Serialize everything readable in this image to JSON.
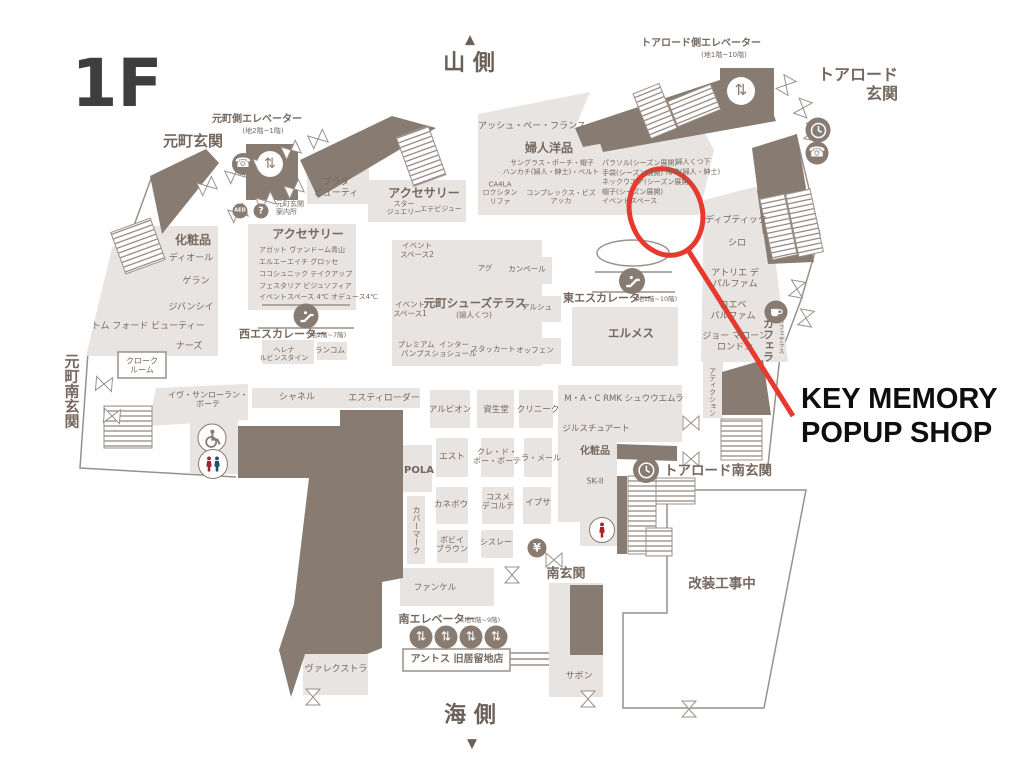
{
  "colors": {
    "floor": "#e8e4e1",
    "dark": "#877b72",
    "ink": "#75685f",
    "line": "#9a9089",
    "red": "#e8392f"
  },
  "annotation": {
    "label": "KEY MEMORY\nPOPUP SHOP"
  },
  "map": {
    "labels": [
      {
        "n": "floor-title",
        "t": "1F",
        "x": 117,
        "y": 84,
        "s": 66,
        "w": "b",
        "c": "#3e3e40"
      },
      {
        "n": "compass-north-arrow",
        "t": "▲",
        "x": 470,
        "y": 40,
        "s": 13,
        "w": "b",
        "c": "#6b6058"
      },
      {
        "n": "compass-north",
        "t": "山 側",
        "x": 469,
        "y": 64,
        "s": 22,
        "w": "b",
        "c": "#6b6058"
      },
      {
        "n": "compass-south",
        "t": "海 側",
        "x": 470,
        "y": 716,
        "s": 22,
        "w": "b",
        "c": "#6b6058"
      },
      {
        "n": "compass-south-arrow",
        "t": "▼",
        "x": 472,
        "y": 744,
        "s": 13,
        "w": "b",
        "c": "#6b6058"
      },
      {
        "n": "motomachi-entrance",
        "t": "元町玄関",
        "x": 193,
        "y": 142,
        "s": 15,
        "w": "b"
      },
      {
        "n": "motomachi-elevator",
        "t": "元町側エレベーター",
        "x": 257,
        "y": 120,
        "s": 10,
        "w": "b"
      },
      {
        "n": "motomachi-elevator-floors",
        "t": "(地2階~1階)",
        "x": 263,
        "y": 131,
        "s": 7
      },
      {
        "n": "motomachi-info",
        "t": "元町玄関\n案内所",
        "x": 276,
        "y": 208,
        "s": 7,
        "a": "l"
      },
      {
        "n": "motomachi-south-entrance",
        "t": "元町南玄関",
        "x": 71,
        "y": 391,
        "s": 15,
        "w": "b",
        "v": true
      },
      {
        "n": "tor-road-entrance",
        "t": "トアロード\n玄関",
        "x": 858,
        "y": 85,
        "s": 16,
        "w": "b",
        "a": "r"
      },
      {
        "n": "tor-road-elevator",
        "t": "トアロード側エレベーター",
        "x": 701,
        "y": 44,
        "s": 10,
        "w": "b"
      },
      {
        "n": "tor-road-elevator-floors",
        "t": "(地1階~10階)",
        "x": 724,
        "y": 55,
        "s": 7
      },
      {
        "n": "tor-road-south-entrance",
        "t": "トアロード南玄関",
        "x": 718,
        "y": 472,
        "s": 13.5,
        "w": "b"
      },
      {
        "n": "south-entrance",
        "t": "南玄関",
        "x": 566,
        "y": 574,
        "s": 13,
        "w": "b"
      },
      {
        "n": "renovation-area-label",
        "t": "改装工事中",
        "x": 722,
        "y": 585,
        "s": 13.5,
        "w": "b"
      },
      {
        "n": "south-elevator",
        "t": "南エレベーター",
        "x": 437,
        "y": 620,
        "s": 11,
        "w": "b"
      },
      {
        "n": "south-elevator-floors",
        "t": "(地1階~9階)",
        "x": 481,
        "y": 621,
        "s": 6.5
      },
      {
        "n": "west-escalator",
        "t": "西エスカレーター",
        "x": 283,
        "y": 335,
        "s": 11,
        "w": "b"
      },
      {
        "n": "west-escalator-floors",
        "t": "(地2階~7階)",
        "x": 327,
        "y": 336,
        "s": 6.5
      },
      {
        "n": "east-escalator",
        "t": "東エスカレーター",
        "x": 607,
        "y": 299,
        "s": 11,
        "w": "b"
      },
      {
        "n": "east-escalator-floors",
        "t": "(地1階~10階)",
        "x": 656,
        "y": 300,
        "s": 6.5
      },
      {
        "n": "store-prada-beauty",
        "t": "プラダ\nビューティ",
        "x": 336,
        "y": 188,
        "s": 9
      },
      {
        "n": "accessories-upper",
        "t": "アクセサリー",
        "x": 424,
        "y": 193,
        "s": 12,
        "w": "b"
      },
      {
        "n": "store-star-jewelry",
        "t": "スター\nジュエリー",
        "x": 404,
        "y": 208,
        "s": 7
      },
      {
        "n": "store-etebijou",
        "t": "エテビジュー",
        "x": 441,
        "y": 209,
        "s": 7
      },
      {
        "n": "store-hp-france",
        "t": "アッシュ・ペー・フランス",
        "x": 532,
        "y": 127,
        "s": 9
      },
      {
        "n": "womens-goods",
        "t": "婦人洋品",
        "x": 549,
        "y": 148,
        "s": 12,
        "w": "b"
      },
      {
        "n": "goods-sunglasses",
        "t": "サングラス・ポーチ・帽子",
        "x": 552,
        "y": 163,
        "s": 7
      },
      {
        "n": "goods-handkerchief",
        "t": "ハンカチ(婦人・紳士)・ベルト",
        "x": 551,
        "y": 172,
        "s": 7
      },
      {
        "n": "store-ca4la-loccitane-refa",
        "t": "CA4LA\nロクシタン\nリファ",
        "x": 500,
        "y": 193,
        "s": 7
      },
      {
        "n": "store-complex-biz-acca",
        "t": "コンプレックス・ビズ\nアッカ",
        "x": 561,
        "y": 197,
        "s": 7
      },
      {
        "n": "goods-parasol",
        "t": "パラソル(シーズン展開)",
        "x": 602,
        "y": 163,
        "s": 7,
        "a": "l"
      },
      {
        "n": "goods-gloves",
        "t": "手袋(シーズン展開)",
        "x": 602,
        "y": 173,
        "s": 7,
        "a": "l"
      },
      {
        "n": "goods-neckwear",
        "t": "ネックウエア(シーズン展開)",
        "x": 602,
        "y": 182,
        "s": 7,
        "a": "l"
      },
      {
        "n": "goods-hats",
        "t": "帽子(シーズン展開)",
        "x": 602,
        "y": 192,
        "s": 7,
        "a": "l"
      },
      {
        "n": "event-space",
        "t": "イベントスペース",
        "x": 602,
        "y": 201,
        "s": 7,
        "a": "l"
      },
      {
        "n": "goods-womens-socks",
        "t": "婦人くつ下",
        "x": 693,
        "y": 162,
        "s": 7
      },
      {
        "n": "goods-umbrellas",
        "t": "雨傘(婦人・紳士)",
        "x": 693,
        "y": 172,
        "s": 7
      },
      {
        "n": "store-diptyque",
        "t": "ディプティック",
        "x": 736,
        "y": 221,
        "s": 9
      },
      {
        "n": "store-shiro",
        "t": "シロ",
        "x": 737,
        "y": 244,
        "s": 9
      },
      {
        "n": "store-atelier-des-parfums",
        "t": "アトリエ デ\nパルファム",
        "x": 735,
        "y": 279,
        "s": 9
      },
      {
        "n": "store-loewe-perfumes",
        "t": "ロエベ\nパルファム",
        "x": 733,
        "y": 311,
        "s": 9
      },
      {
        "n": "store-jo-malone-london",
        "t": "ジョー マローン\nロンドン",
        "x": 735,
        "y": 342,
        "s": 9
      },
      {
        "n": "store-caffera",
        "t": "カフェラ",
        "x": 768,
        "y": 340,
        "s": 11,
        "w": "b",
        "v": true
      },
      {
        "n": "cafe-terrace",
        "t": "カフェテラス",
        "x": 780,
        "y": 336,
        "s": 6,
        "v": true
      },
      {
        "n": "store-addiction",
        "t": "アディクション",
        "x": 712,
        "y": 392,
        "s": 7,
        "v": true
      },
      {
        "n": "cosmetics-left",
        "t": "化粧品",
        "x": 193,
        "y": 240,
        "s": 12,
        "w": "b"
      },
      {
        "n": "store-dior",
        "t": "ディオール",
        "x": 191,
        "y": 259,
        "s": 9
      },
      {
        "n": "store-guerlain",
        "t": "ゲラン",
        "x": 196,
        "y": 282,
        "s": 9
      },
      {
        "n": "store-givenchy",
        "t": "ジバンシイ",
        "x": 191,
        "y": 308,
        "s": 9
      },
      {
        "n": "store-tom-ford-beauty",
        "t": "トム フォード ビューティー",
        "x": 148,
        "y": 327,
        "s": 9
      },
      {
        "n": "store-nars",
        "t": "ナーズ",
        "x": 189,
        "y": 347,
        "s": 9
      },
      {
        "n": "cloakroom",
        "t": "クローク\nルーム",
        "x": 142,
        "y": 366,
        "s": 8
      },
      {
        "n": "accessories-left",
        "t": "アクセサリー",
        "x": 308,
        "y": 234,
        "s": 12,
        "w": "b"
      },
      {
        "n": "store-agete-vendome",
        "t": "アガット ヴァンドーム青山",
        "x": 259,
        "y": 250,
        "s": 7,
        "a": "l"
      },
      {
        "n": "store-lah-grosse",
        "t": "エルエーエイチ グロッセ",
        "x": 259,
        "y": 262,
        "s": 7,
        "a": "l"
      },
      {
        "n": "store-cocoshnik-takeup",
        "t": "ココシュニック テイクアップ",
        "x": 259,
        "y": 274,
        "s": 7,
        "a": "l"
      },
      {
        "n": "store-festaria",
        "t": "フェスタリア ビジュソフィア",
        "x": 259,
        "y": 286,
        "s": 7,
        "a": "l"
      },
      {
        "n": "store-event-4c",
        "t": "イベントスペース 4℃ オデュース4℃",
        "x": 259,
        "y": 297,
        "s": 7,
        "a": "l"
      },
      {
        "n": "store-helena-rubinstein",
        "t": "ヘレナ\nルビンスタイン",
        "x": 284,
        "y": 354,
        "s": 7
      },
      {
        "n": "store-lancome",
        "t": "ランコム",
        "x": 330,
        "y": 351,
        "s": 7.5
      },
      {
        "n": "event-space-2",
        "t": "イベント\nスペース2",
        "x": 417,
        "y": 251,
        "s": 7.5
      },
      {
        "n": "store-ugg",
        "t": "アグ",
        "x": 485,
        "y": 269,
        "s": 7.5
      },
      {
        "n": "store-camper",
        "t": "カンペール",
        "x": 527,
        "y": 270,
        "s": 7.5
      },
      {
        "n": "shoes-terrace",
        "t": "元町シューズテラス",
        "x": 475,
        "y": 304,
        "s": 11.5,
        "w": "b"
      },
      {
        "n": "shoes-terrace-sub",
        "t": "(婦人くつ)",
        "x": 474,
        "y": 316,
        "s": 7.5
      },
      {
        "n": "event-space-1",
        "t": "イベント\nスペース1",
        "x": 410,
        "y": 310,
        "s": 7.5
      },
      {
        "n": "store-arche",
        "t": "アルシュ",
        "x": 537,
        "y": 308,
        "s": 7.5
      },
      {
        "n": "store-premium-pumps",
        "t": "プレミアム\nパンプス",
        "x": 416,
        "y": 350,
        "s": 7.5
      },
      {
        "n": "store-inter-chaussures",
        "t": "インター\nショシュール",
        "x": 454,
        "y": 350,
        "s": 7.5
      },
      {
        "n": "store-staccato",
        "t": "スタッカート",
        "x": 493,
        "y": 350,
        "s": 7.5
      },
      {
        "n": "store-offen",
        "t": "オッフェン",
        "x": 535,
        "y": 351,
        "s": 7.5
      },
      {
        "n": "store-hermes",
        "t": "エルメス",
        "x": 631,
        "y": 334,
        "s": 11.5,
        "w": "b"
      },
      {
        "n": "store-ysl-beaute",
        "t": "イヴ・サンローラン・\nボーテ",
        "x": 208,
        "y": 400,
        "s": 8
      },
      {
        "n": "store-chanel",
        "t": "シャネル",
        "x": 297,
        "y": 398,
        "s": 9
      },
      {
        "n": "store-estee-lauder",
        "t": "エスティローダー",
        "x": 384,
        "y": 399,
        "s": 9
      },
      {
        "n": "store-albion",
        "t": "アルビオン",
        "x": 450,
        "y": 410,
        "s": 8.5
      },
      {
        "n": "store-shiseido",
        "t": "資生堂",
        "x": 496,
        "y": 410,
        "s": 8.5
      },
      {
        "n": "store-clinique",
        "t": "クリニーク",
        "x": 538,
        "y": 410,
        "s": 8.5
      },
      {
        "n": "store-est",
        "t": "エスト",
        "x": 452,
        "y": 457,
        "s": 8.5
      },
      {
        "n": "store-cle-de-peau",
        "t": "クレ・ド・\nポー・ボーテ",
        "x": 497,
        "y": 457,
        "s": 8
      },
      {
        "n": "store-la-mer",
        "t": "ラ・メール",
        "x": 541,
        "y": 458,
        "s": 8
      },
      {
        "n": "store-pola",
        "t": "POLA",
        "x": 419,
        "y": 471,
        "s": 10,
        "w": "b"
      },
      {
        "n": "store-kanebo",
        "t": "カネボウ",
        "x": 451,
        "y": 505,
        "s": 8.5
      },
      {
        "n": "store-cosme-decorte",
        "t": "コスメ\nデコルテ",
        "x": 498,
        "y": 502,
        "s": 8
      },
      {
        "n": "store-ipsa",
        "t": "イプサ",
        "x": 538,
        "y": 503,
        "s": 8.5
      },
      {
        "n": "store-covermark",
        "t": "カバーマーク",
        "x": 416,
        "y": 530,
        "s": 8,
        "v": true
      },
      {
        "n": "store-bobbi-brown",
        "t": "ボビイ\nブラウン",
        "x": 452,
        "y": 545,
        "s": 8
      },
      {
        "n": "store-sisley",
        "t": "シスレー",
        "x": 496,
        "y": 542,
        "s": 8
      },
      {
        "n": "store-mac-rmk-shu",
        "t": "M・A・C RMK シュウウエムラ",
        "x": 624,
        "y": 399,
        "s": 8.5
      },
      {
        "n": "store-jill-stuart",
        "t": "ジルスチュアート",
        "x": 596,
        "y": 429,
        "s": 8.5
      },
      {
        "n": "cosmetics-right",
        "t": "化粧品",
        "x": 595,
        "y": 452,
        "s": 10,
        "w": "b"
      },
      {
        "n": "store-sk2",
        "t": "SK-II",
        "x": 595,
        "y": 481,
        "s": 8
      },
      {
        "n": "store-fancl",
        "t": "ファンケル",
        "x": 435,
        "y": 588,
        "s": 8.5
      },
      {
        "n": "store-anthos",
        "t": "アントス 旧居留地店",
        "x": 457,
        "y": 660,
        "s": 10,
        "w": "b"
      },
      {
        "n": "store-sabon",
        "t": "サボン",
        "x": 579,
        "y": 677,
        "s": 9
      },
      {
        "n": "store-valextra",
        "t": "ヴァレクストラ",
        "x": 336,
        "y": 670,
        "s": 9
      }
    ],
    "icons": [
      {
        "type": "phone",
        "x": 243,
        "y": 164,
        "d": 22
      },
      {
        "type": "elevator",
        "x": 270,
        "y": 164,
        "d": 26,
        "variant": "light"
      },
      {
        "type": "aed",
        "x": 240,
        "y": 211,
        "d": 15
      },
      {
        "type": "question",
        "x": 261,
        "y": 211,
        "d": 15
      },
      {
        "type": "elevator",
        "x": 741,
        "y": 91,
        "d": 28,
        "variant": "light"
      },
      {
        "type": "clock",
        "x": 818,
        "y": 130,
        "d": 25
      },
      {
        "type": "phone",
        "x": 817,
        "y": 153,
        "d": 23
      },
      {
        "type": "escalator",
        "x": 306,
        "y": 316,
        "d": 25
      },
      {
        "type": "escalator",
        "x": 632,
        "y": 281,
        "d": 26
      },
      {
        "type": "coffee",
        "x": 776,
        "y": 312,
        "d": 23
      },
      {
        "type": "clock",
        "x": 646,
        "y": 470,
        "d": 26
      },
      {
        "type": "wheelchair",
        "x": 212,
        "y": 438,
        "d": 29,
        "variant": "ring"
      },
      {
        "type": "restroom",
        "x": 213,
        "y": 464,
        "d": 30,
        "variant": "ring"
      },
      {
        "type": "female",
        "x": 602,
        "y": 530,
        "d": 26,
        "variant": "ring"
      },
      {
        "type": "atm",
        "x": 537,
        "y": 548,
        "d": 19
      },
      {
        "type": "elevator",
        "x": 421,
        "y": 637,
        "d": 23
      },
      {
        "type": "elevator",
        "x": 446,
        "y": 637,
        "d": 23
      },
      {
        "type": "elevator",
        "x": 471,
        "y": 637,
        "d": 23
      },
      {
        "type": "elevator",
        "x": 496,
        "y": 637,
        "d": 23
      }
    ]
  }
}
